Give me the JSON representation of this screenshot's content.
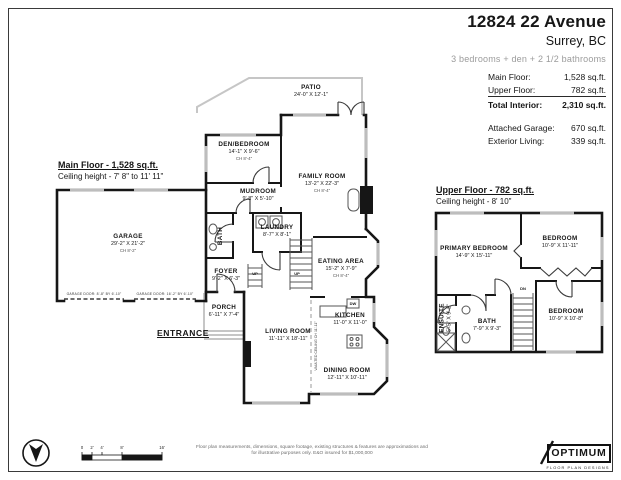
{
  "header": {
    "address": "12824 22 Avenue",
    "city": "Surrey, BC",
    "summary": "3 bedrooms + den + 2 1/2 bathrooms",
    "area_rows": [
      {
        "label": "Main Floor:",
        "value": "1,528 sq.ft."
      },
      {
        "label": "Upper Floor:",
        "value": "782 sq.ft."
      },
      {
        "label": "Total Interior:",
        "value": "2,310 sq.ft."
      }
    ],
    "extra_rows": [
      {
        "label": "Attached Garage:",
        "value": "670 sq.ft."
      },
      {
        "label": "Exterior Living:",
        "value": "339 sq.ft."
      }
    ]
  },
  "main_floor": {
    "heading": "Main Floor - 1,528 sq.ft.",
    "ceiling": "Ceiling height - 7' 8\" to 11' 11\"",
    "entrance_label": "ENTRANCE",
    "garage_door_left": "GARAGE DOOR: 8'-8\" BY 6'-10\"",
    "garage_door_right": "GARAGE DOOR: 16'-2\" BY 6'-10\"",
    "vaulted_note": "VAULTED CEILING CH 11'-11\"",
    "rooms": {
      "garage": {
        "name": "GARAGE",
        "dims": "29'-2\" X 21'-2\"",
        "ch": "CH 8'-2\""
      },
      "patio": {
        "name": "PATIO",
        "dims": "24'-0\" X 12'-1\""
      },
      "den": {
        "name": "DEN/BEDROOM",
        "dims": "14'-1\" X 9'-6\"",
        "ch": "CH 8'-4\""
      },
      "family": {
        "name": "FAMILY ROOM",
        "dims": "13'-2\" X 22'-3\"",
        "ch": "CH 8'-4\""
      },
      "mudroom": {
        "name": "MUDROOM",
        "dims": "9'-8\" X 5'-10\""
      },
      "laundry": {
        "name": "LAUNDRY",
        "dims": "8'-7\" X 8'-1\""
      },
      "bath": {
        "name": "BATH"
      },
      "foyer": {
        "name": "FOYER",
        "dims": "9'-2\" X 6'-3\""
      },
      "porch": {
        "name": "PORCH",
        "dims": "6'-11\" X 7'-4\""
      },
      "eating": {
        "name": "EATING AREA",
        "dims": "15'-2\" X 7'-9\"",
        "ch": "CH 8'-4\""
      },
      "kitchen": {
        "name": "KITCHEN",
        "dims": "11'-0\" X 11'-0\""
      },
      "living": {
        "name": "LIVING ROOM",
        "dims": "11'-11\" X 18'-11\""
      },
      "dining": {
        "name": "DINING ROOM",
        "dims": "12'-11\" X 10'-11\""
      }
    }
  },
  "upper_floor": {
    "heading": "Upper Floor - 782 sq.ft.",
    "ceiling": "Ceiling height - 8' 10\"",
    "rooms": {
      "primary": {
        "name": "PRIMARY BEDROOM",
        "dims": "14'-9\" X 15'-11\""
      },
      "bedroom1": {
        "name": "BEDROOM",
        "dims": "10'-9\" X 11'-11\""
      },
      "bedroom2": {
        "name": "BEDROOM",
        "dims": "10'-9\" X 10'-8\""
      },
      "bath": {
        "name": "BATH",
        "dims": "7'-9\" X 9'-3\""
      },
      "ensuite": {
        "name": "ENSUITE",
        "dims": "5'-5\" X 9'-2\""
      }
    }
  },
  "markers": {
    "up": "UP",
    "dn": "DN",
    "dw": "DW"
  },
  "footer": {
    "scale_labels": [
      "0",
      "2'",
      "4'",
      "8'",
      "16'"
    ],
    "disclaimer_line1": "Floor plan measurements, dimensions, square footage, existing structures & features are approximations and",
    "disclaimer_line2": "for illustrative purposes only. E&O insured for $1,000,000",
    "logo_name": "OPTIMUM",
    "logo_sub": "FLOOR PLAN DESIGNS"
  },
  "colors": {
    "wall": "#161616",
    "window": "#bdbdbd",
    "light_outline": "#c6c6c6",
    "muted_text": "#9b9b9b"
  }
}
